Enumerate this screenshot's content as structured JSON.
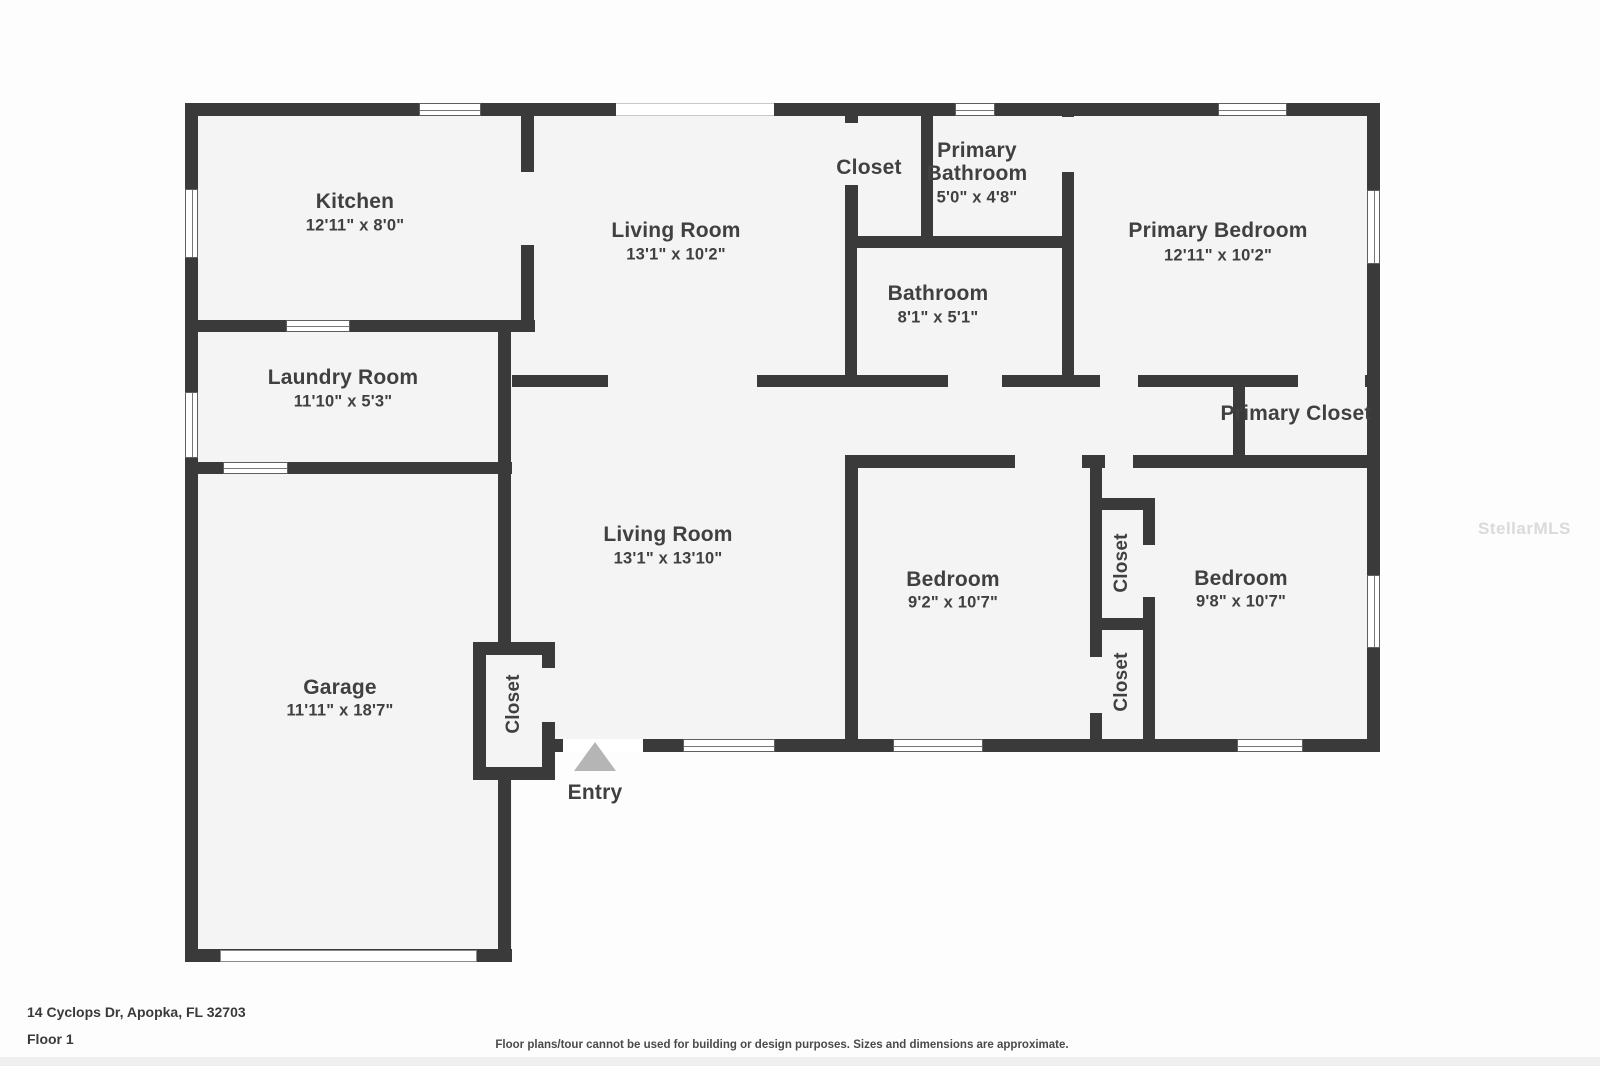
{
  "meta": {
    "address": "14 Cyclops Dr, Apopka, FL 32703",
    "floor_label": "Floor 1",
    "disclaimer": "Floor plans/tour cannot be used for building or design purposes. Sizes and dimensions are approximate.",
    "watermark": "StellarMLS",
    "entry_label": "Entry"
  },
  "colors": {
    "wall": "#3a3a3a",
    "floor": "#f5f4f4",
    "text": "#404040",
    "entry_arrow": "#b5b5b5"
  },
  "rooms": {
    "kitchen": {
      "name": "Kitchen",
      "dims": "12'11\" x 8'0\""
    },
    "living_room_top": {
      "name": "Living Room",
      "dims": "13'1\" x 10'2\""
    },
    "closet_top": {
      "name": "Closet"
    },
    "primary_bathroom": {
      "name_line1": "Primary",
      "name_line2": "Bathroom",
      "dims": "5'0\" x 4'8\""
    },
    "primary_bedroom": {
      "name": "Primary Bedroom",
      "dims": "12'11\" x 10'2\""
    },
    "bathroom": {
      "name": "Bathroom",
      "dims": "8'1\" x 5'1\""
    },
    "laundry_room": {
      "name": "Laundry Room",
      "dims": "11'10\" x 5'3\""
    },
    "primary_closet": {
      "name": "Primary Closet"
    },
    "living_room_bottom": {
      "name": "Living Room",
      "dims": "13'1\" x 13'10\""
    },
    "bedroom_left": {
      "name": "Bedroom",
      "dims": "9'2\" x 10'7\""
    },
    "bedroom_right": {
      "name": "Bedroom",
      "dims": "9'8\" x 10'7\""
    },
    "closet_middle_upper": {
      "name": "Closet"
    },
    "closet_middle_lower": {
      "name": "Closet"
    },
    "garage": {
      "name": "Garage",
      "dims": "11'11\" x 18'7\""
    },
    "closet_entry": {
      "name": "Closet"
    }
  }
}
